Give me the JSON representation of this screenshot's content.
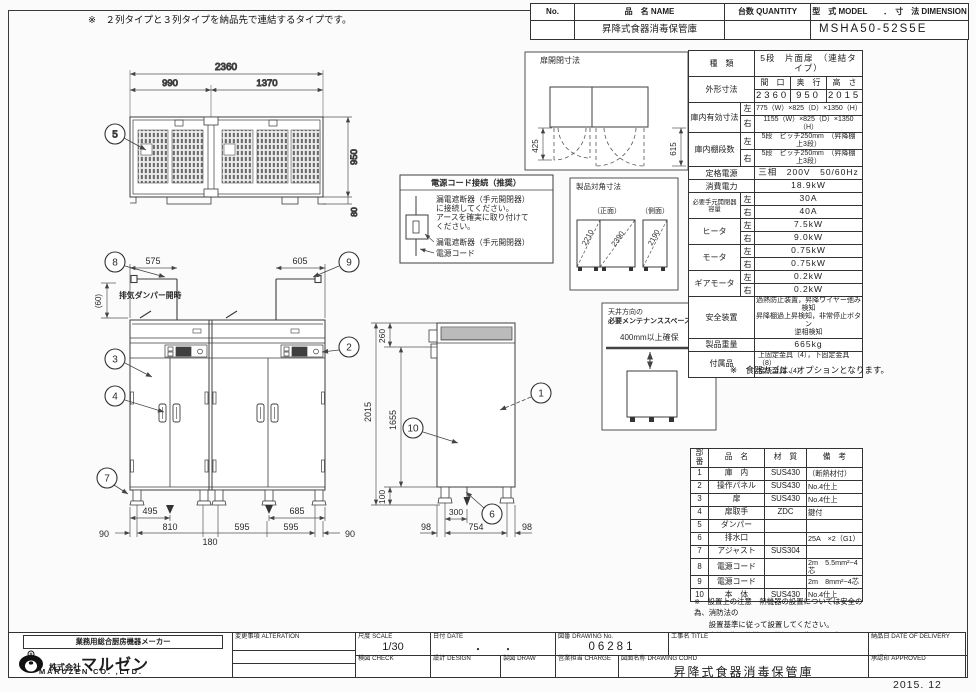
{
  "sheet": {
    "top_note": "※　２列タイプと３列タイプを納品先で連結するタイプです。",
    "issue_date": "2015. 12"
  },
  "header": {
    "no_label": "No.",
    "name_label": "品　名 NAME",
    "qty_label": "台数 QUANTITY",
    "model_label": "型　式 MODEL　　．　寸　法 DIMENSION",
    "name_value": "昇降式食器消毒保管庫",
    "model_value": "MSHA50-52S5E"
  },
  "spec": {
    "kind_label": "種　類",
    "kind_value": "5段　片面扉　（連結タイプ）",
    "outer_label": "外形寸法",
    "outer_w_label": "間　口",
    "outer_d_label": "奥　行",
    "outer_h_label": "高　さ",
    "outer_w": "2360",
    "outer_d": "950",
    "outer_h": "2015",
    "left_label": "左",
    "right_label": "右",
    "inner_label": "庫内有効寸法",
    "inner_left": "775（W）×825（D）×1350（H）",
    "inner_right": "1155（W）×825（D）×1350（H）",
    "shelf_label": "庫内棚段数",
    "shelf_left": "5段　ピッチ250mm　（昇降棚　上3段）",
    "shelf_right": "5段　ピッチ250mm　（昇降棚　上3段）",
    "power_label": "定格電源",
    "power_value": "三相　200V　50/60Hz",
    "watt_label": "消費電力",
    "watt_value": "18.9kW",
    "breaker_label": "必要手元開閉器容量",
    "breaker_left": "30A",
    "breaker_right": "40A",
    "heater_label": "ヒータ",
    "heater_left": "7.5kW",
    "heater_right": "9.0kW",
    "motor_label": "モータ",
    "motor_left": "0.75kW",
    "motor_right": "0.75kW",
    "gear_label": "ギアモータ",
    "gear_left": "0.2kW",
    "gear_right": "0.2kW",
    "safety_label": "安全装置",
    "safety_line1": "過熱防止装置，昇降ワイヤー弛み検知",
    "safety_line2": "昇降棚過上昇検知，非常停止ボタン",
    "safety_line3": "逆相検知",
    "weight_label": "製品重量",
    "weight_value": "665kg",
    "acc_label": "付属品",
    "acc_line1": "上固定金具（4），下固定金具（8）",
    "acc_line2": "接続金具（4）",
    "option_note": "※　食器カゴは、オプションとなります。"
  },
  "parts": {
    "h_no": "部番",
    "h_name": "品　名",
    "h_material": "材　質",
    "h_note": "備　考",
    "rows": [
      {
        "no": "1",
        "name": "庫　内",
        "mat": "SUS430",
        "note": "（断熱材付）"
      },
      {
        "no": "2",
        "name": "操作パネル",
        "mat": "SUS430",
        "note": "No.4仕上"
      },
      {
        "no": "3",
        "name": "扉",
        "mat": "SUS430",
        "note": "No.4仕上"
      },
      {
        "no": "4",
        "name": "扉取手",
        "mat": "ZDC",
        "note": "鍵付"
      },
      {
        "no": "5",
        "name": "ダンパー",
        "mat": "",
        "note": ""
      },
      {
        "no": "6",
        "name": "排水口",
        "mat": "",
        "note": "25A　×2（G1）"
      },
      {
        "no": "7",
        "name": "アジャスト",
        "mat": "SUS304",
        "note": ""
      },
      {
        "no": "8",
        "name": "電源コード",
        "mat": "",
        "note": "2m　5.5mm²−4芯"
      },
      {
        "no": "9",
        "name": "電源コード",
        "mat": "",
        "note": "2m　8mm²−4芯"
      },
      {
        "no": "10",
        "name": "本　体",
        "mat": "SUS430",
        "note": "No.4仕上"
      }
    ],
    "note1a": "※　設置上の注意　熱機器の設置については安全の為、消防法の",
    "note1b": "　　設置基準に従って設置してください。",
    "note2": "※　改善の為、仕様及び外観を予告なしに変更することがあります。"
  },
  "titleblock": {
    "tagline": "業務用総合厨房機器メーカー",
    "company_prefix": "株式会社",
    "company_name": "マルゼン",
    "company_en": "MARUZEN CO. ,LTD.",
    "alteration_label": "変更事項 ALTERATION",
    "scale_label": "尺度 SCALE",
    "scale_value": "1/30",
    "date_label": "日付 DATE",
    "date_value": "・　　・",
    "dwg_label": "図番 DRAWING No.",
    "dwg_value": "06281",
    "title_label": "工事名 TITLE",
    "check_label": "検図 CHECK",
    "design_label": "設計 DESIGN",
    "draw_label": "製図 DRAW",
    "charge_label": "営業担当 CHARGE",
    "dwgname_label": "図面名称 DRAWING CORD",
    "dwgname_value": "昇降式食器消毒保管庫",
    "delivery_label": "納品日 DATE OF DELIVERY",
    "approved_label": "承認印 APPROVED"
  },
  "dims": {
    "top_view": {
      "total_w": "2360",
      "left_w": "990",
      "right_w": "1370",
      "depth": "950",
      "rear": "80"
    },
    "front": {
      "cord_left": "575",
      "cord_right": "605",
      "damper_h": "(60)",
      "damper_note": "排気ダンパー開時",
      "drain_left": "495",
      "drain_right": "685",
      "b90l": "90",
      "b810": "810",
      "b180": "180",
      "b595a": "595",
      "b595b": "595",
      "b90r": "90"
    },
    "side": {
      "top_h": "260",
      "total_h": "2015",
      "inner_h": "1655",
      "leg_h": "100",
      "drain_x": "300",
      "f98l": "98",
      "f754": "754",
      "f98r": "98"
    },
    "door_box": {
      "title": "扉開閉寸法",
      "left": "425",
      "right": "615"
    },
    "power_box": {
      "title": "電源コード接続（推奨）",
      "l1": "漏電遮断器（手元開閉器）",
      "l2": "に接続してください。",
      "l3": "アースを確実に取り付けて",
      "l4": "ください。",
      "cap1": "漏電遮断器（手元開閉器）",
      "cap2": "電源コード"
    },
    "diag_box": {
      "title": "製品対角寸法",
      "front_cap": "（正面）",
      "side_cap": "（側面）",
      "d1": "2210",
      "d2": "2390",
      "d3": "2190"
    },
    "maint_box": {
      "l1": "天井方向の",
      "l2": "必要メンテナンススペース",
      "l3": "400mm以上確保"
    },
    "balloons": {
      "b1": "1",
      "b2": "2",
      "b3": "3",
      "b4": "4",
      "b5": "5",
      "b6": "6",
      "b7": "7",
      "b8": "8",
      "b9": "9",
      "b10": "10"
    }
  }
}
